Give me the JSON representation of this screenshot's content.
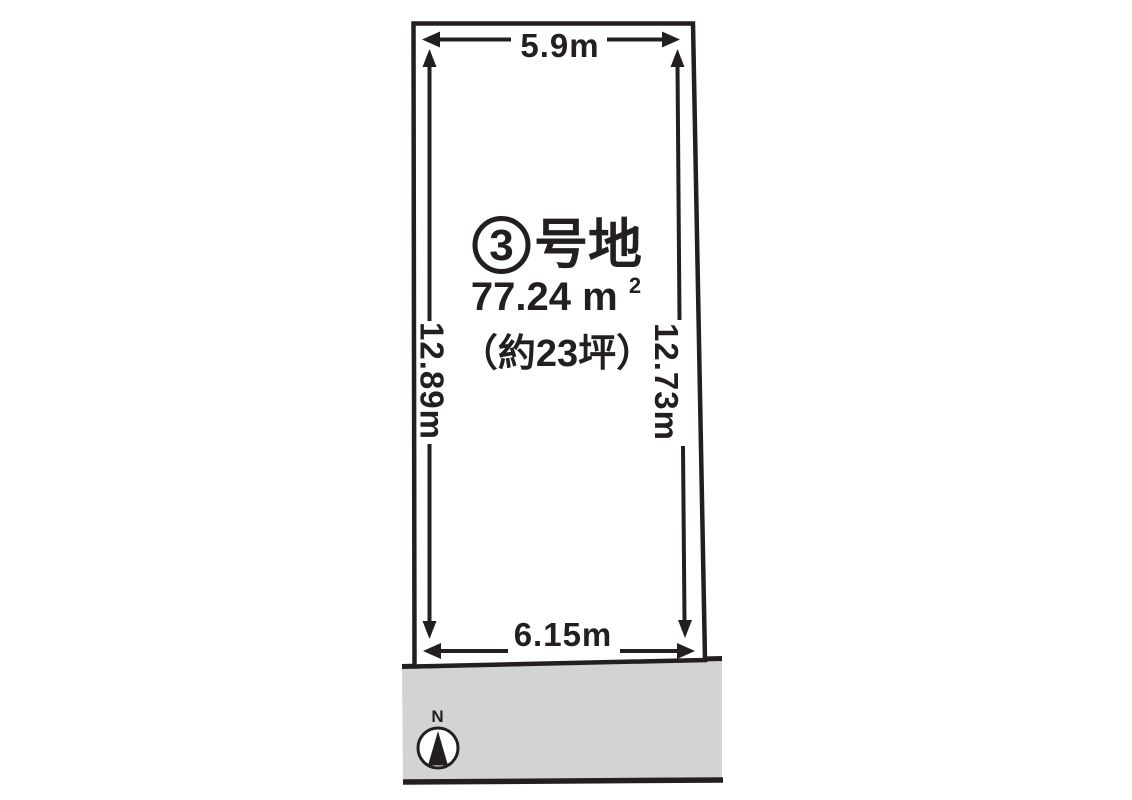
{
  "diagram": {
    "plot": {
      "number": "3",
      "name_suffix": "号地"
    },
    "area": {
      "sqm_value": "77.24",
      "sqm_unit": "m",
      "sqm_sup": "2",
      "tsubo": "（約23坪）"
    },
    "dimensions": {
      "top": "5.9m",
      "left": "12.89m",
      "right": "12.73m",
      "bottom": "6.15m"
    },
    "compass": {
      "north_label": "N"
    },
    "colors": {
      "ink": "#231f20",
      "accent_red": "#e60012",
      "road_gray": "#d3d3d4"
    }
  }
}
